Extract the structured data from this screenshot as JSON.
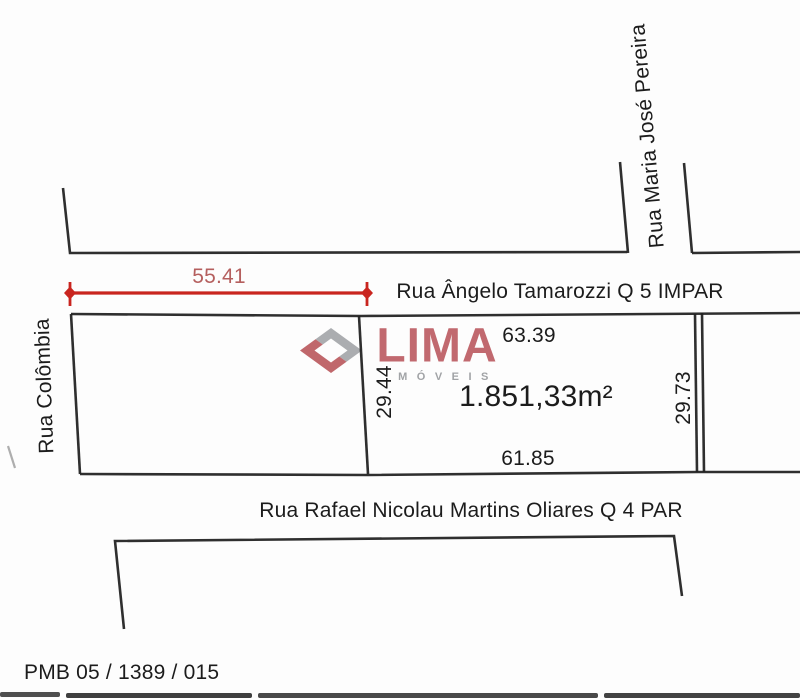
{
  "colors": {
    "paper": "#fdfdfd",
    "ink": "#1c1c1c",
    "line": "#222222",
    "dimRed": "#c9251f",
    "dimLabel": "#b55f5e",
    "logoRed": "#bf646a",
    "logoGray": "#a1a3a6"
  },
  "streets": {
    "top": {
      "label": "Rua Ângelo Tamarozzi Q 5 IMPAR"
    },
    "bottom": {
      "label": "Rua Rafael Nicolau Martins Oliares Q 4 PAR"
    },
    "left": {
      "label": "Rua Colômbia"
    },
    "upper_right": {
      "label": "Rua Maria José Pereira"
    }
  },
  "dimension_line": {
    "length": "55.41"
  },
  "lot": {
    "area": "1.851,33m²",
    "sides": {
      "front": "63.39",
      "back": "61.85",
      "left": "29.44",
      "right": "29.73"
    }
  },
  "watermark": {
    "brand": "LIMA",
    "tagline": "MÓVEIS"
  },
  "footer": {
    "reference": "PMB 05 / 1389 / 015"
  }
}
